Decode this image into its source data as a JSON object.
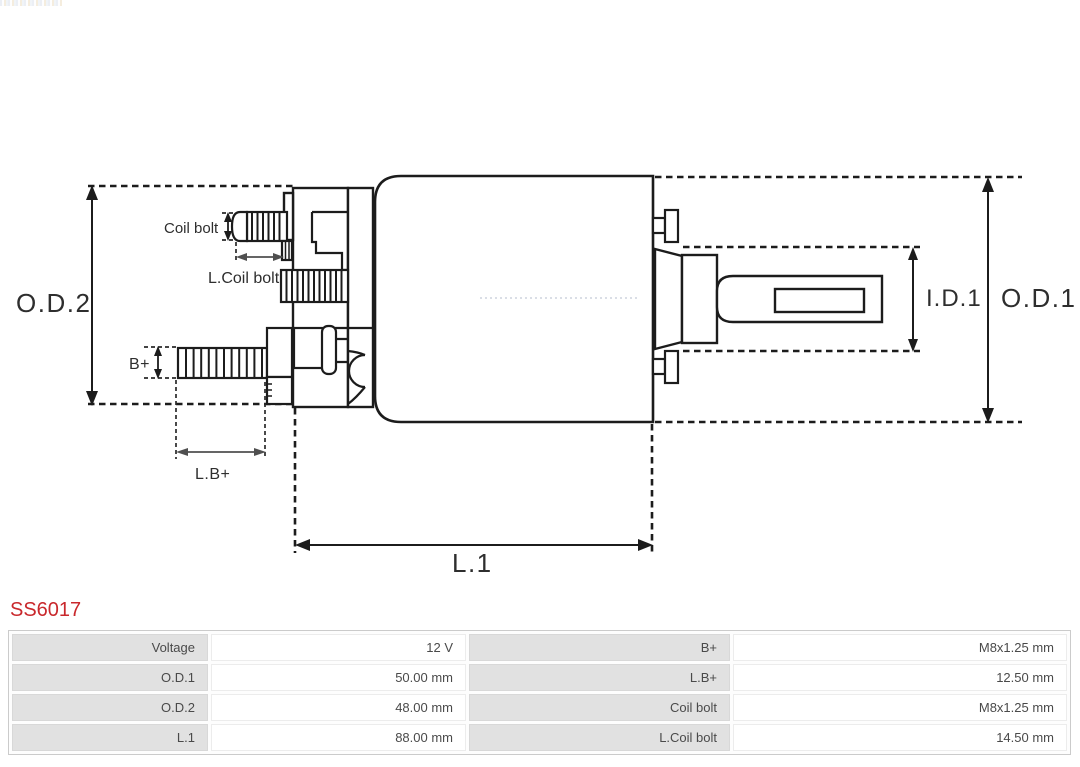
{
  "product": {
    "code": "SS6017"
  },
  "diagram": {
    "labels": {
      "od2": "O.D.2",
      "od1": "O.D.1",
      "id1": "I.D.1",
      "l1": "L.1",
      "lb_plus": "L.B+",
      "b_plus": "B+",
      "coil_bolt": "Coil bolt",
      "l_coil_bolt": "L.Coil bolt"
    }
  },
  "colors": {
    "product_code": "#c9282c",
    "diagram_line": "#1c1c1c",
    "dim_gray_arrow": "#4f4f4f",
    "table_label_bg": "#e1e1e1",
    "table_text": "#4a4a4a"
  },
  "spec_table": {
    "rows": [
      {
        "label1": "Voltage",
        "value1": "12 V",
        "label2": "B+",
        "value2": "M8x1.25 mm"
      },
      {
        "label1": "O.D.1",
        "value1": "50.00 mm",
        "label2": "L.B+",
        "value2": "12.50 mm"
      },
      {
        "label1": "O.D.2",
        "value1": "48.00 mm",
        "label2": "Coil bolt",
        "value2": "M8x1.25 mm"
      },
      {
        "label1": "L.1",
        "value1": "88.00 mm",
        "label2": "L.Coil bolt",
        "value2": "14.50 mm"
      }
    ]
  }
}
